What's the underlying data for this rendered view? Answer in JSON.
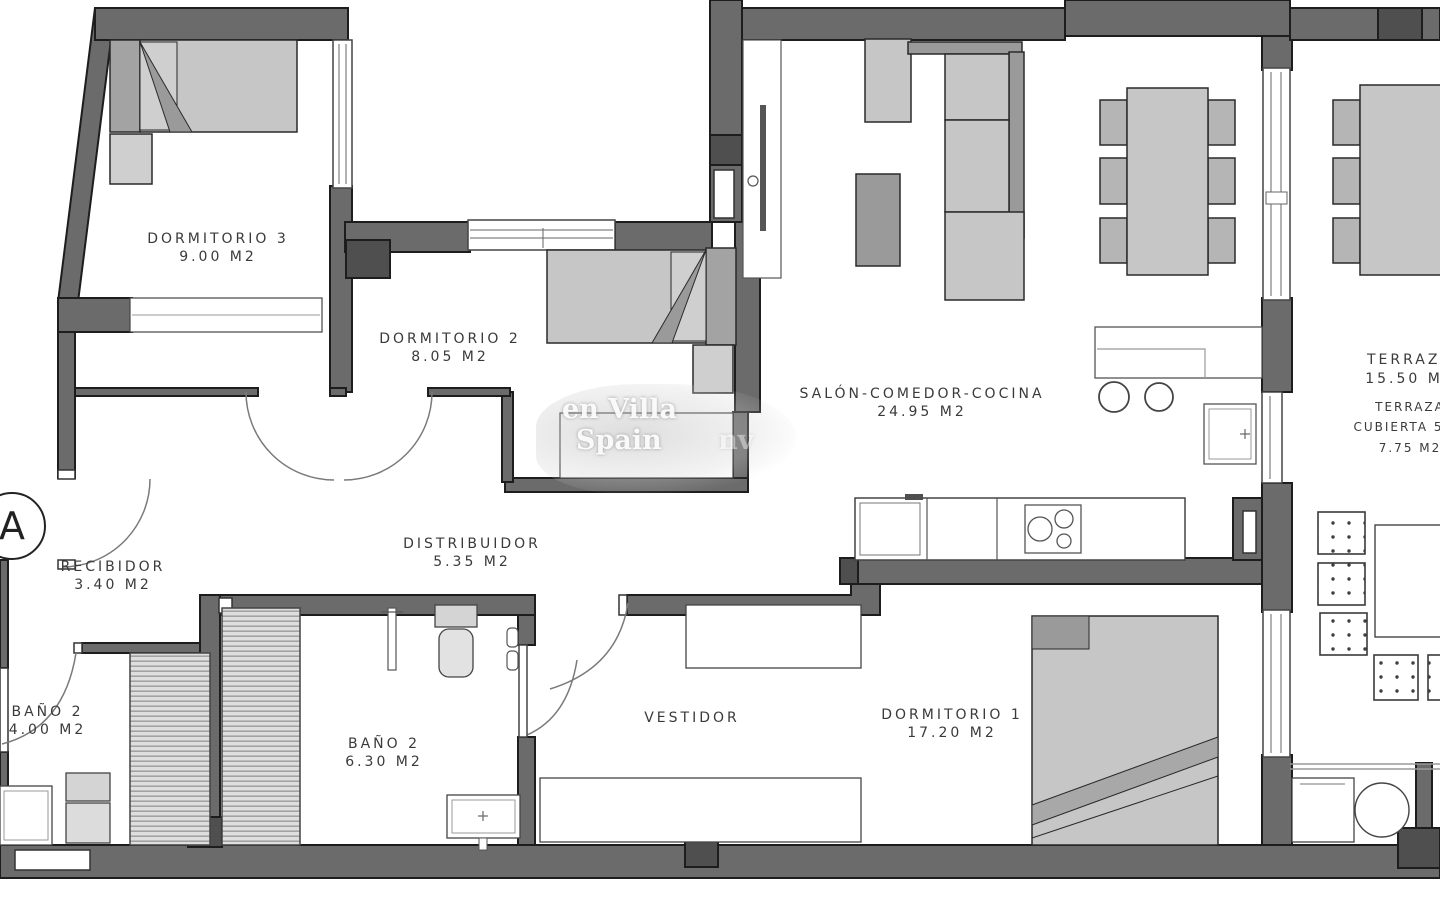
{
  "rooms": [
    {
      "name": "DORMITORIO 3",
      "area": "9.00 M2"
    },
    {
      "name": "DORMITORIO 2",
      "area": "8.05 M2"
    },
    {
      "name": "SALÓN-COMEDOR-COCINA",
      "area": "24.95 M2"
    },
    {
      "name": "RECIBIDOR",
      "area": "3.40 M2"
    },
    {
      "name": "DISTRIBUIDOR",
      "area": "5.35 M2"
    },
    {
      "name": "BAÑO 2",
      "area": "4.00 M2"
    },
    {
      "name": "BAÑO 2",
      "area": "6.30 M2"
    },
    {
      "name": "VESTIDOR",
      "area": ""
    },
    {
      "name": "DORMITORIO 1",
      "area": "17.20 M2"
    },
    {
      "name": "TERRAZA",
      "area": "15.50 M2"
    },
    {
      "name": "TERRAZA",
      "detail": "CUBIERTA 50%",
      "area": "7.75 M2"
    }
  ],
  "section_marker": "A",
  "watermark": {
    "line1": "en Villa",
    "line2": "Spain",
    "line3": "nv"
  }
}
